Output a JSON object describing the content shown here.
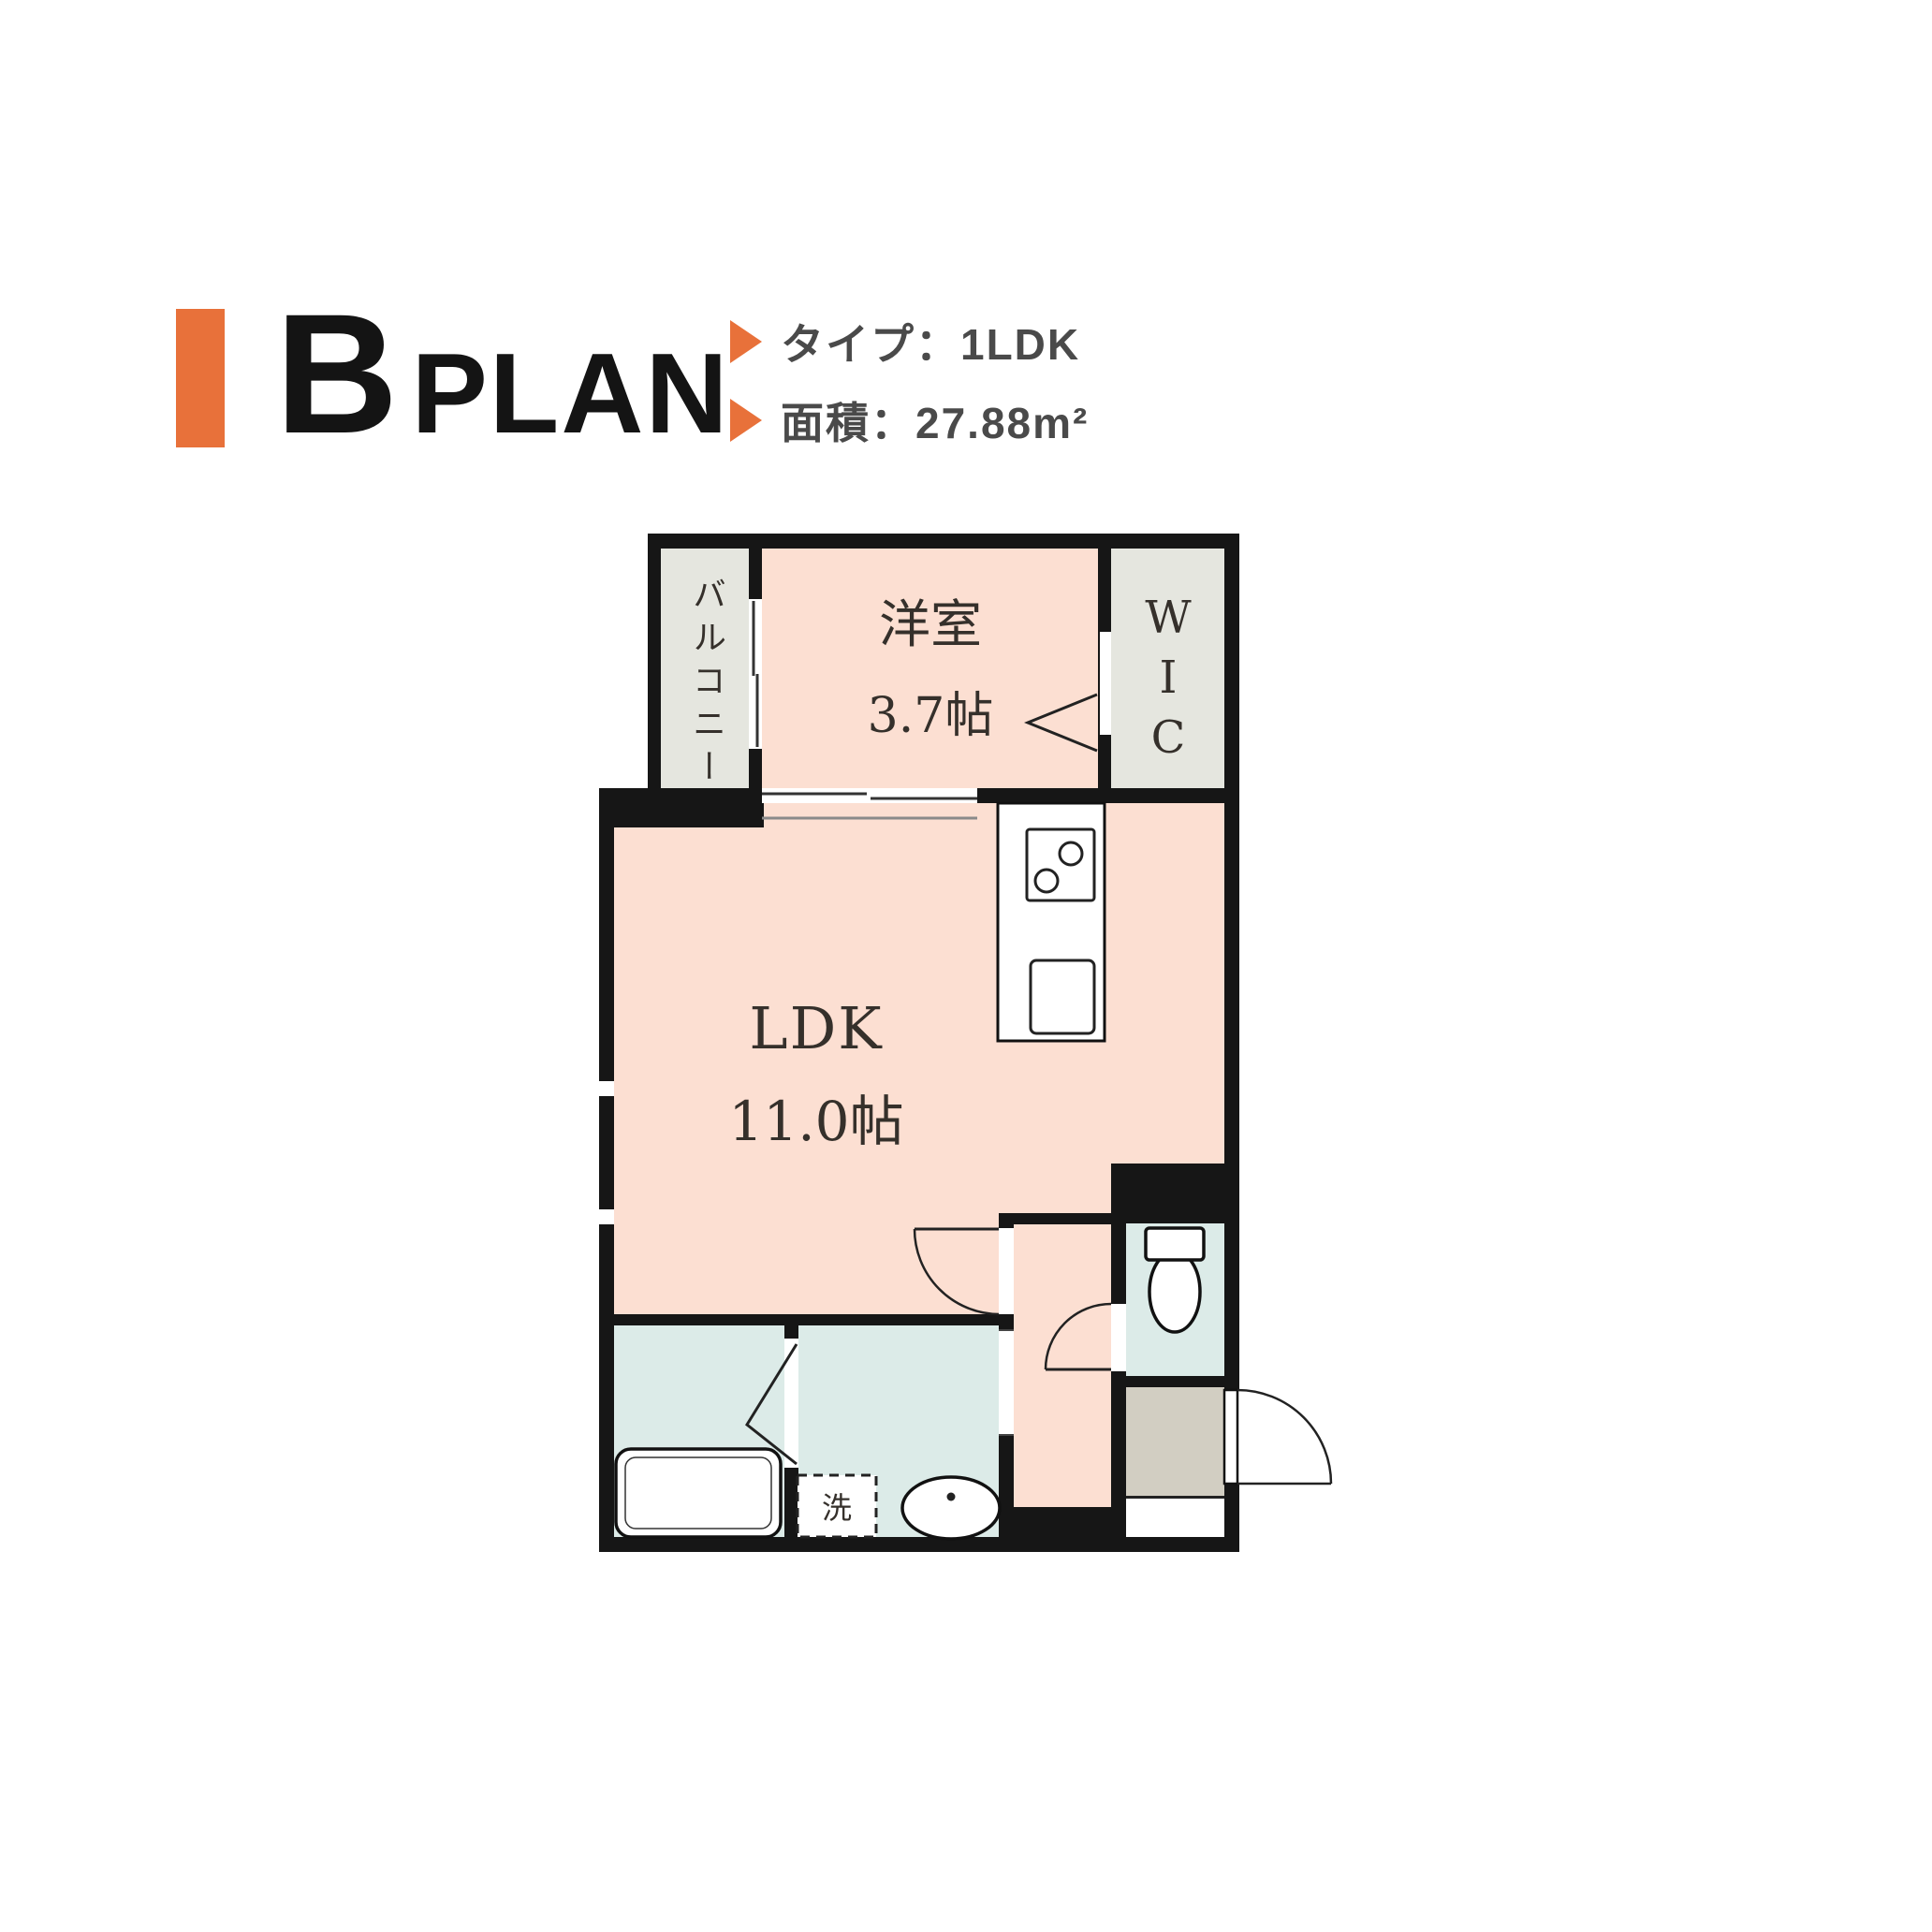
{
  "header": {
    "plan_letter": "B",
    "plan_word": "PLAN",
    "type_line": "タイプ：1LDK",
    "area_line": "面積：27.88m²"
  },
  "floorplan": {
    "balcony": "バルコニー",
    "western_room": {
      "name": "洋室",
      "size": "3.7帖"
    },
    "wic_letters": [
      "W",
      "I",
      "C"
    ],
    "ldk": {
      "name": "LDK",
      "size": "11.0帖"
    },
    "laundry": "洗"
  },
  "colors": {
    "accent_orange": "#e8713a",
    "text_dark": "#4a4a4a",
    "room_pink": "#fcdfd2",
    "wet_blue": "#dcebe8",
    "outdoor_gray": "#e5e6df",
    "entrance_beige": "#d2cec2",
    "wall_black": "#161616"
  }
}
